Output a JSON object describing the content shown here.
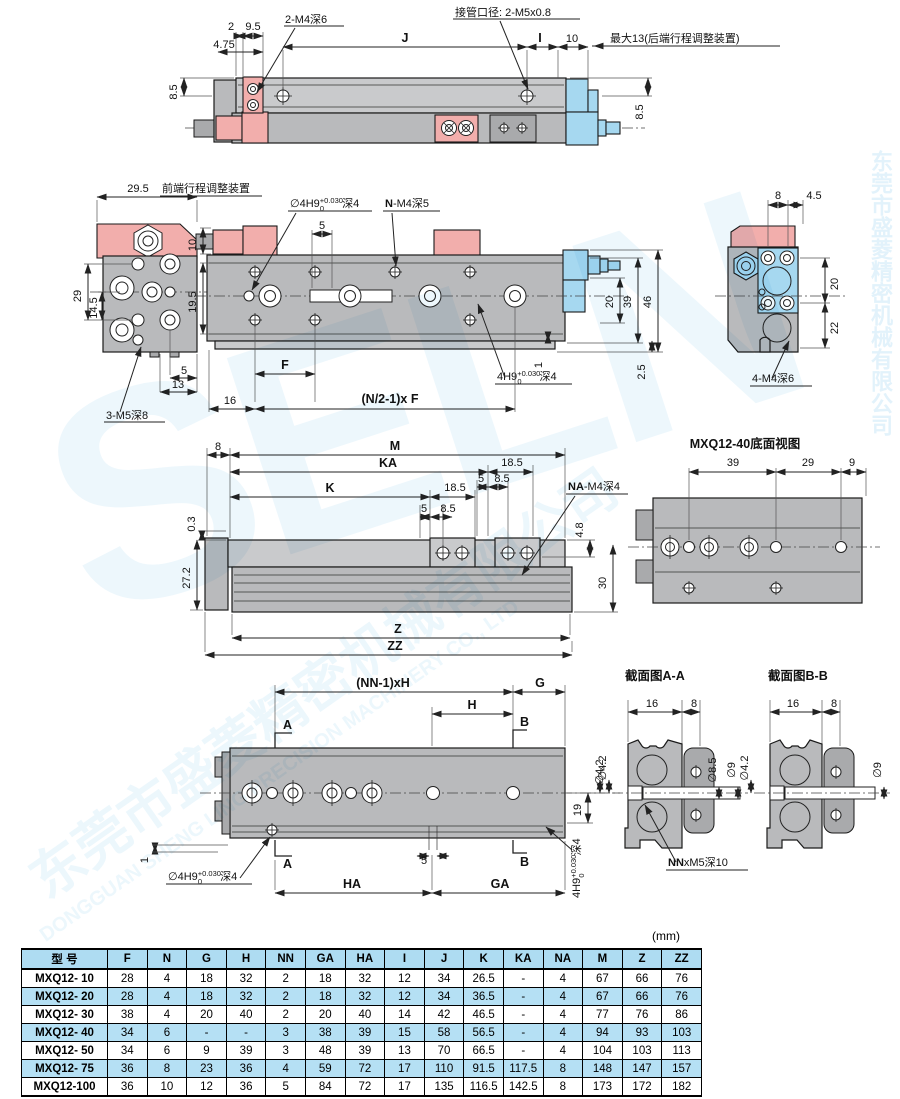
{
  "unit_note": "(mm)",
  "watermark": {
    "brand": "SELN",
    "cn": "东莞市盛菱精密机械有限公司",
    "en": "DONGGUAN SHENG LING PRECISION MACHINERY CO., LTD",
    "cn_vertical": "东莞市盛菱精密机械有限公司"
  },
  "top_view": {
    "d2": "2",
    "d9_5": "9.5",
    "d4_75": "4.75",
    "thread_label": "2-M4深6",
    "J": "J",
    "port_label": "接管口径: 2-M5x0.8",
    "I": "I",
    "d10": "10",
    "max13": "最大13(后端行程调整装置)",
    "d8_5_left": "8.5",
    "d8_5_right": "8.5"
  },
  "front_view": {
    "d29_5": "29.5",
    "adjuster_label": "前端行程调整装置",
    "d10": "10",
    "d29": "29",
    "d14_5": "14.5",
    "d5_bottom": "5",
    "d13": "13",
    "thread_3m5": "3-M5深8",
    "hole_tol": {
      "prefix": "∅4H9",
      "sup": "+0.030",
      "sub": "0",
      "suffix": "深4"
    },
    "d5_slot": "5",
    "n_bold": "N",
    "n_rest": "-M4深5",
    "d19_5": "19.5",
    "d8": "8",
    "d4_5": "4.5",
    "d20": "20",
    "d39": "39",
    "d46": "46",
    "d1": "1",
    "d2_5": "2.5",
    "hole_tol2": {
      "prefix": "4H9",
      "sup": "+0.030",
      "sub": "0",
      "suffix": "深4"
    },
    "side_d20": "20",
    "side_d22": "22",
    "thread_4m4": "4-M4深6",
    "F": "F",
    "pitch_formula": "(N/2-1)x F",
    "d16": "16"
  },
  "bottom_view": {
    "d8": "8",
    "M": "M",
    "KA": "KA",
    "K": "K",
    "d18_5_a": "18.5",
    "d5_a": "5",
    "d8_5_a": "8.5",
    "d18_5_b": "18.5",
    "d5_b": "5",
    "d8_5_b": "8.5",
    "na_bold": "NA",
    "na_rest": "-M4深4",
    "d0_3": "0.3",
    "d27_2": "27.2",
    "d4_8": "4.8",
    "d30": "30",
    "Z": "Z",
    "ZZ": "ZZ",
    "title40": "MXQ12-40底面视图",
    "d39": "39",
    "d29": "29",
    "d9": "9"
  },
  "mount_view": {
    "nn_formula": "(NN-1)xH",
    "G": "G",
    "H": "H",
    "secA": "A",
    "secB": "B",
    "dia4_2": "∅4.2",
    "d19": "19",
    "d1": "1",
    "hole_tol": {
      "prefix": "∅4H9",
      "sup": "+0.030",
      "sub": "0",
      "suffix": "深4"
    },
    "d5": "5",
    "HA": "HA",
    "GA": "GA",
    "rot_tol": {
      "prefix": "4H9",
      "sup": "+0.030",
      "sub": "0",
      "suffix": "深4"
    }
  },
  "sections": {
    "a_title": "截面图A-A",
    "b_title": "截面图B-B",
    "a_d16": "16",
    "a_d8": "8",
    "a_dia4_2": "∅4.2",
    "a_dia8_5": "∅8.5",
    "a_dia9": "∅9",
    "nn_bold": "NN",
    "nn_rest": "xM5深10",
    "b_d16": "16",
    "b_d8": "8",
    "b_dia4_2": "∅4.2",
    "b_dia9": "∅9"
  },
  "table": {
    "headers": [
      "型 号",
      "F",
      "N",
      "G",
      "H",
      "NN",
      "GA",
      "HA",
      "I",
      "J",
      "K",
      "KA",
      "NA",
      "M",
      "Z",
      "ZZ"
    ],
    "rows": [
      {
        "model": "MXQ12- 10",
        "highlight": false,
        "values": [
          "28",
          "4",
          "18",
          "32",
          "2",
          "18",
          "32",
          "12",
          "34",
          "26.5",
          "-",
          "4",
          "67",
          "66",
          "76"
        ]
      },
      {
        "model": "MXQ12- 20",
        "highlight": true,
        "values": [
          "28",
          "4",
          "18",
          "32",
          "2",
          "18",
          "32",
          "12",
          "34",
          "36.5",
          "-",
          "4",
          "67",
          "66",
          "76"
        ]
      },
      {
        "model": "MXQ12- 30",
        "highlight": false,
        "values": [
          "38",
          "4",
          "20",
          "40",
          "2",
          "20",
          "40",
          "14",
          "42",
          "46.5",
          "-",
          "4",
          "77",
          "76",
          "86"
        ]
      },
      {
        "model": "MXQ12- 40",
        "highlight": true,
        "values": [
          "34",
          "6",
          "-",
          "-",
          "3",
          "38",
          "39",
          "15",
          "58",
          "56.5",
          "-",
          "4",
          "94",
          "93",
          "103"
        ]
      },
      {
        "model": "MXQ12- 50",
        "highlight": false,
        "values": [
          "34",
          "6",
          "9",
          "39",
          "3",
          "48",
          "39",
          "13",
          "70",
          "66.5",
          "-",
          "4",
          "104",
          "103",
          "113"
        ]
      },
      {
        "model": "MXQ12- 75",
        "highlight": true,
        "values": [
          "36",
          "8",
          "23",
          "36",
          "4",
          "59",
          "72",
          "17",
          "110",
          "91.5",
          "117.5",
          "8",
          "148",
          "147",
          "157"
        ]
      },
      {
        "model": "MXQ12-100",
        "highlight": false,
        "values": [
          "36",
          "10",
          "12",
          "36",
          "5",
          "84",
          "72",
          "17",
          "135",
          "116.5",
          "142.5",
          "8",
          "173",
          "172",
          "182"
        ]
      }
    ]
  }
}
